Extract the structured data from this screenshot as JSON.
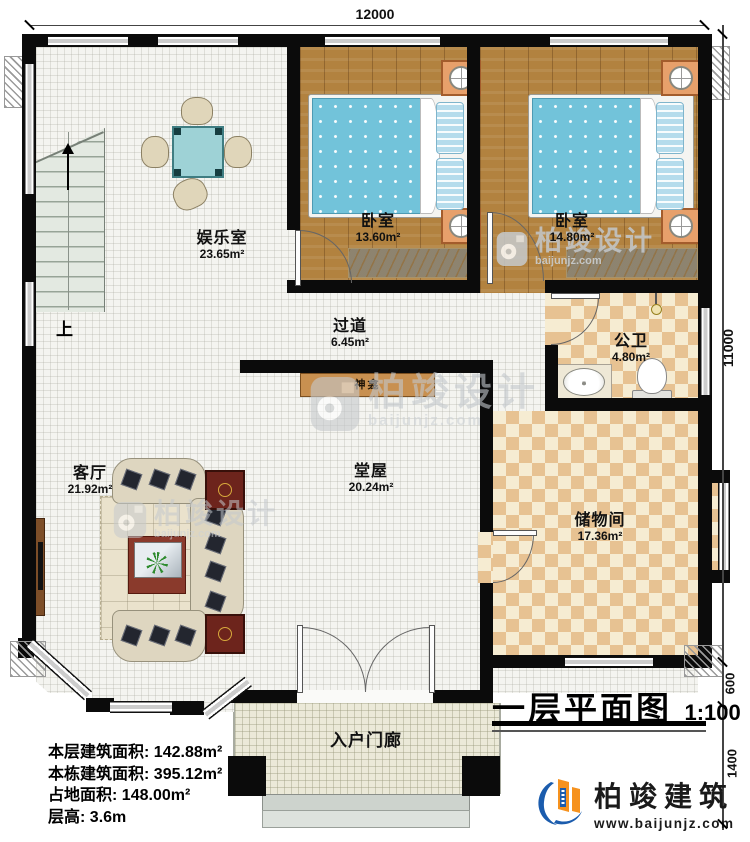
{
  "dimensions": {
    "top_width": "12000",
    "right_height": "11000",
    "porch_step": "600",
    "porch_depth": "1400"
  },
  "rooms": [
    {
      "name": "娱乐室",
      "area": "23.65m²"
    },
    {
      "name": "卧室",
      "area": "13.60m²"
    },
    {
      "name": "卧室",
      "area": "14.80m²"
    },
    {
      "name": "过道",
      "area": "6.45m²"
    },
    {
      "name": "公卫",
      "area": "4.80m²"
    },
    {
      "name": "客厅",
      "area": "21.92m²"
    },
    {
      "name": "堂屋",
      "area": "20.24m²"
    },
    {
      "name": "储物间",
      "area": "17.36m²"
    },
    {
      "name": "入户门廊",
      "area": ""
    }
  ],
  "annotations": {
    "stairs_up": "上",
    "shrine": "神龛"
  },
  "stats": {
    "lines": [
      {
        "label": "本层建筑面积:",
        "value": "142.88m²"
      },
      {
        "label": "本栋建筑面积:",
        "value": "395.12m²"
      },
      {
        "label": "占地面积:",
        "value": "148.00m²"
      },
      {
        "label": "层高:",
        "value": "3.6m"
      }
    ]
  },
  "title_block": {
    "title": "一层平面图",
    "scale": "1:100"
  },
  "brand": {
    "name": "柏竣建筑",
    "website": "www.baijunjz.com"
  },
  "watermark": {
    "name": "柏竣设计",
    "site": "baijunjz.com"
  },
  "colors": {
    "wall": "#0b0b0b",
    "wood_floor": "#b2823f",
    "tile_light": "#f6ecd2",
    "tile_dark": "#e7c292",
    "mattress_blue": "#72c3da",
    "logo_blue": "#1b5cad",
    "logo_orange": "#f6921e"
  }
}
